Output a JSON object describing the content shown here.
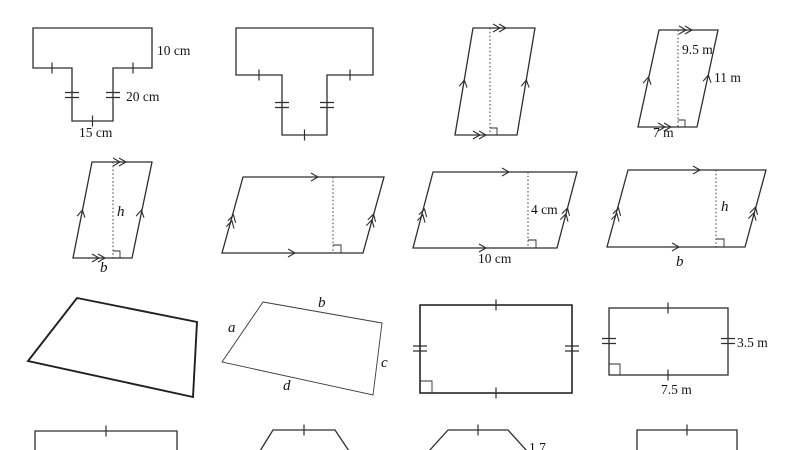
{
  "page": {
    "background": "#ffffff",
    "line_color": "#2e2e2e",
    "description": "Worksheet grid of sixteen plane-geometry figures"
  },
  "figures": [
    {
      "name": "t-shape-labeled",
      "type": "t-shape",
      "labels": {
        "side_right": "10 cm",
        "stem": "20 cm",
        "bottom": "15 cm"
      }
    },
    {
      "name": "t-shape-unlabeled",
      "type": "t-shape",
      "labels": {}
    },
    {
      "name": "parallelogram-steep-height",
      "type": "parallelogram",
      "labels": {}
    },
    {
      "name": "parallelogram-steep-labeled",
      "type": "parallelogram",
      "labels": {
        "height": "9.5 m",
        "side": "11 m",
        "base": "7 m"
      }
    },
    {
      "name": "parallelogram-steep-hb",
      "type": "parallelogram",
      "labels": {
        "height": "h",
        "base": "b"
      }
    },
    {
      "name": "parallelogram-wide-height",
      "type": "parallelogram",
      "labels": {}
    },
    {
      "name": "parallelogram-wide-labeled",
      "type": "parallelogram",
      "labels": {
        "height": "4 cm",
        "base": "10 cm"
      }
    },
    {
      "name": "parallelogram-wide-hb",
      "type": "parallelogram",
      "labels": {
        "height": "h",
        "base": "b"
      }
    },
    {
      "name": "quadrilateral-plain",
      "type": "quadrilateral",
      "labels": {}
    },
    {
      "name": "quadrilateral-abcd",
      "type": "quadrilateral",
      "labels": {
        "a": "a",
        "b": "b",
        "c": "c",
        "d": "d"
      }
    },
    {
      "name": "rectangle-ticks",
      "type": "rectangle",
      "labels": {}
    },
    {
      "name": "rectangle-labeled",
      "type": "rectangle",
      "labels": {
        "side": "3.5 m",
        "base": "7.5 m"
      }
    },
    {
      "name": "partial-rectangle-1",
      "type": "partial",
      "labels": {}
    },
    {
      "name": "partial-trapezoid-1",
      "type": "partial",
      "labels": {}
    },
    {
      "name": "partial-trapezoid-2",
      "type": "partial",
      "labels": {
        "partial": "1.7"
      }
    },
    {
      "name": "partial-rectangle-2",
      "type": "partial",
      "labels": {}
    }
  ]
}
